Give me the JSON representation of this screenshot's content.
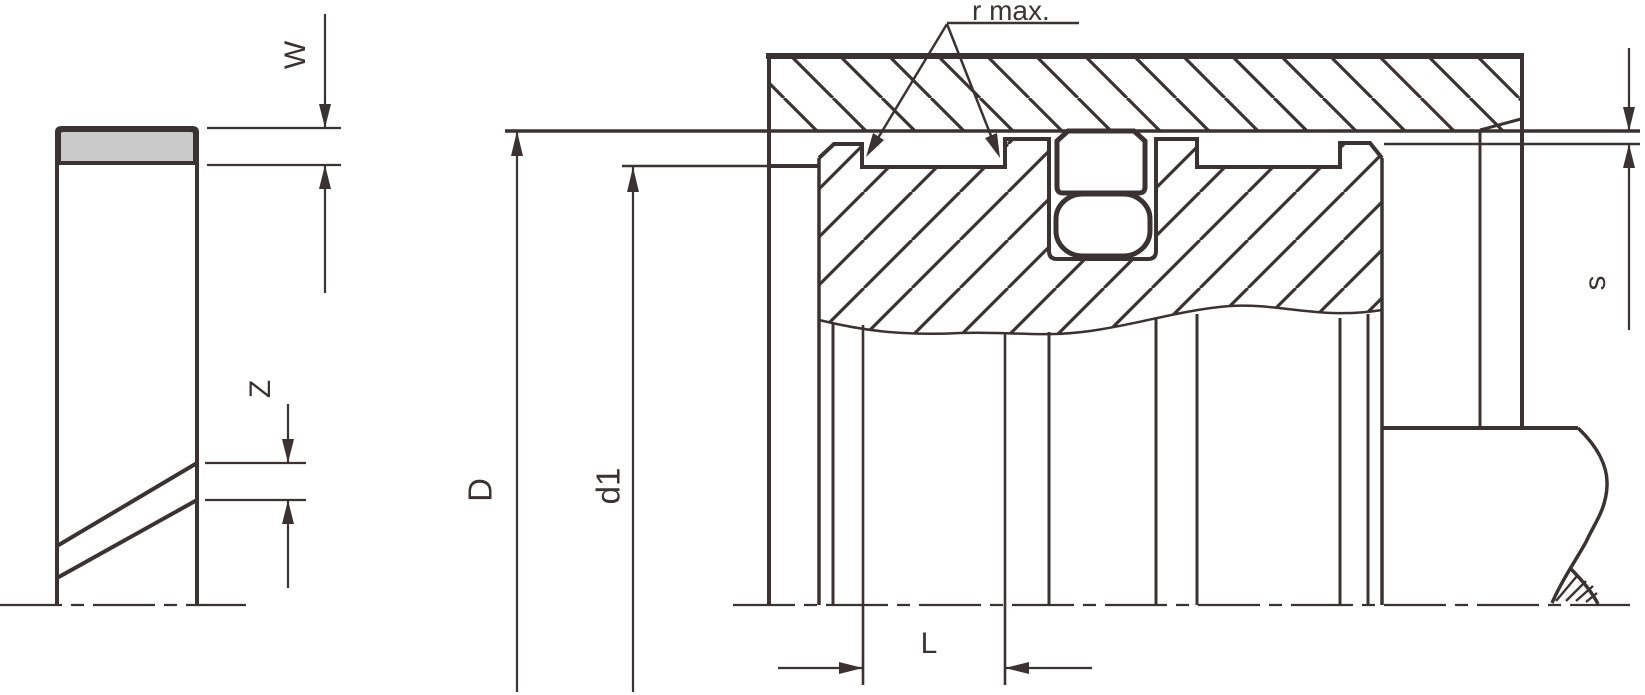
{
  "drawing": {
    "labels": {
      "seal_width": "W",
      "gap": "Z",
      "bore_diameter": "D",
      "groove_diameter": "d1",
      "groove_width": "L",
      "radial_clearance": "s",
      "corner_radius": "r max."
    },
    "colors": {
      "line": "#3a3331",
      "seal_band_fill": "#cacaca",
      "background": "#ffffff"
    }
  }
}
